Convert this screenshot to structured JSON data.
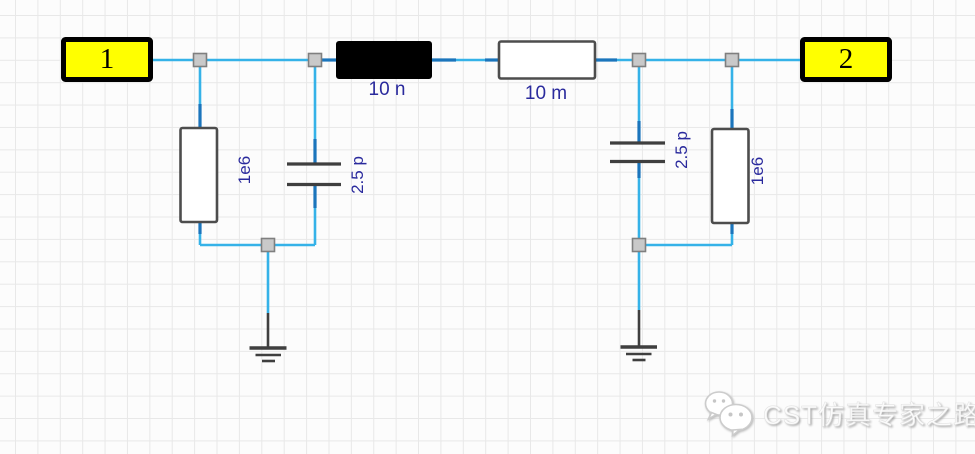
{
  "app": {
    "type": "circuit-schematic-editor",
    "canvas": "grid-schematic"
  },
  "colors": {
    "wire_color": "#35b2e8",
    "pin_color": "#1b75bc",
    "port_fill": "#ffff00",
    "label_color": "#2a2a9d",
    "component_outline": "#4d4d4d",
    "ground_color": "#3f3f3f",
    "junction_fill": "#c9c9c9",
    "junction_border": "#7f7f7f",
    "grid_line": "#e8e8e8",
    "canvas_bg": "#fcfcfc"
  },
  "ports": {
    "port1_label": "1",
    "port2_label": "2"
  },
  "components": {
    "series_inductor_value": "10 n",
    "series_resistor_value": "10 m",
    "left_shunt_resistor_value": "1e6",
    "right_shunt_resistor_value": "1e6",
    "left_shunt_capacitor_value": "2.5 p",
    "right_shunt_capacitor_value": "2.5 p"
  },
  "watermark": {
    "icon": "wechat-logo",
    "text": "CST仿真专家之路"
  }
}
